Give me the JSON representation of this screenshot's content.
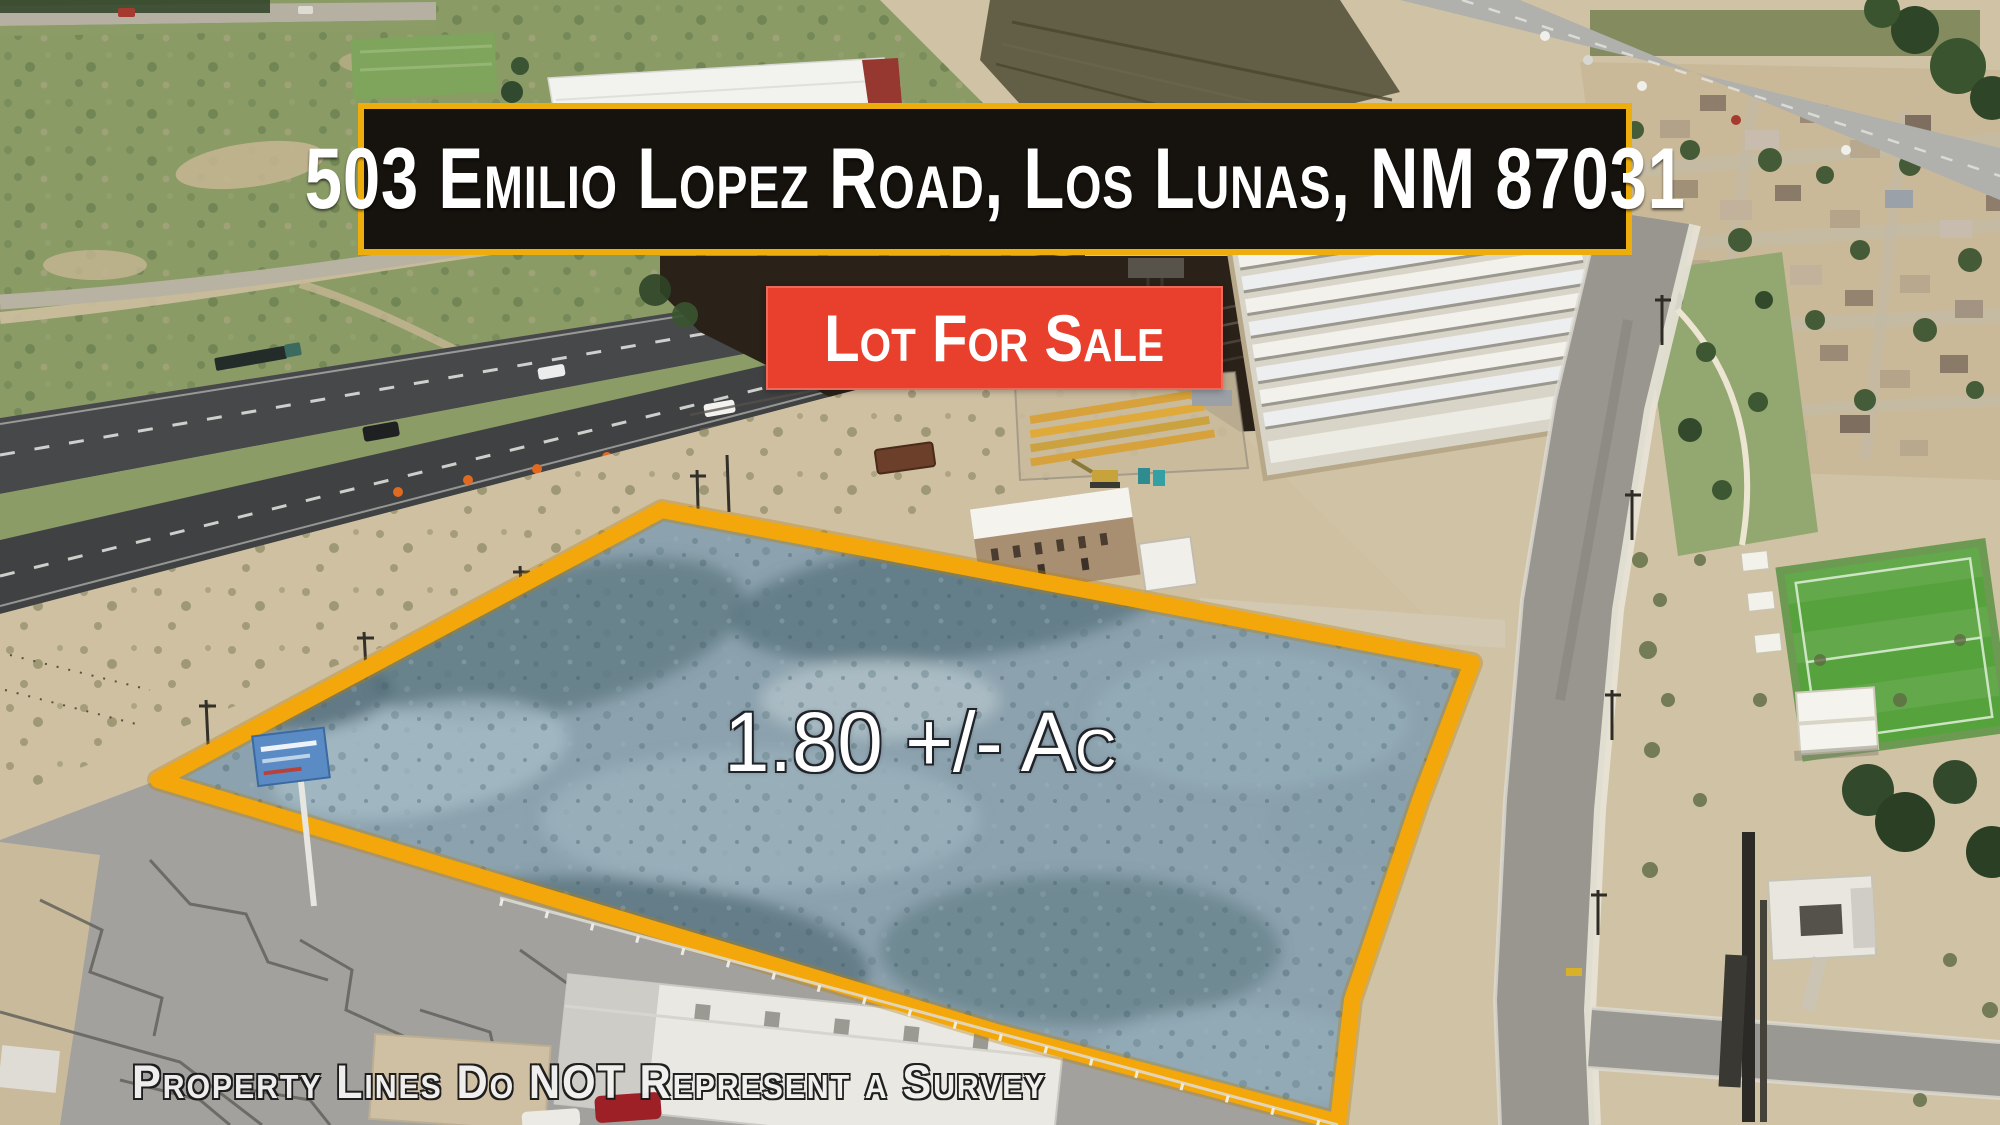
{
  "address_banner": {
    "text": "503 Emilio Lopez Road, Los Lunas, NM 87031"
  },
  "sale_badge": {
    "text": "Lot For Sale"
  },
  "lot": {
    "area_label": "1.80 +/- Ac"
  },
  "disclaimer": {
    "text": "Property Lines Do NOT Represent a Survey"
  },
  "colors": {
    "banner_background": "#16120D",
    "banner_border": "#EDAD0C",
    "badge_background": "#E8402C",
    "lot_outline": "#F4A70A",
    "lot_fill": "#8CA2AE",
    "text": "#FFFFFF"
  }
}
